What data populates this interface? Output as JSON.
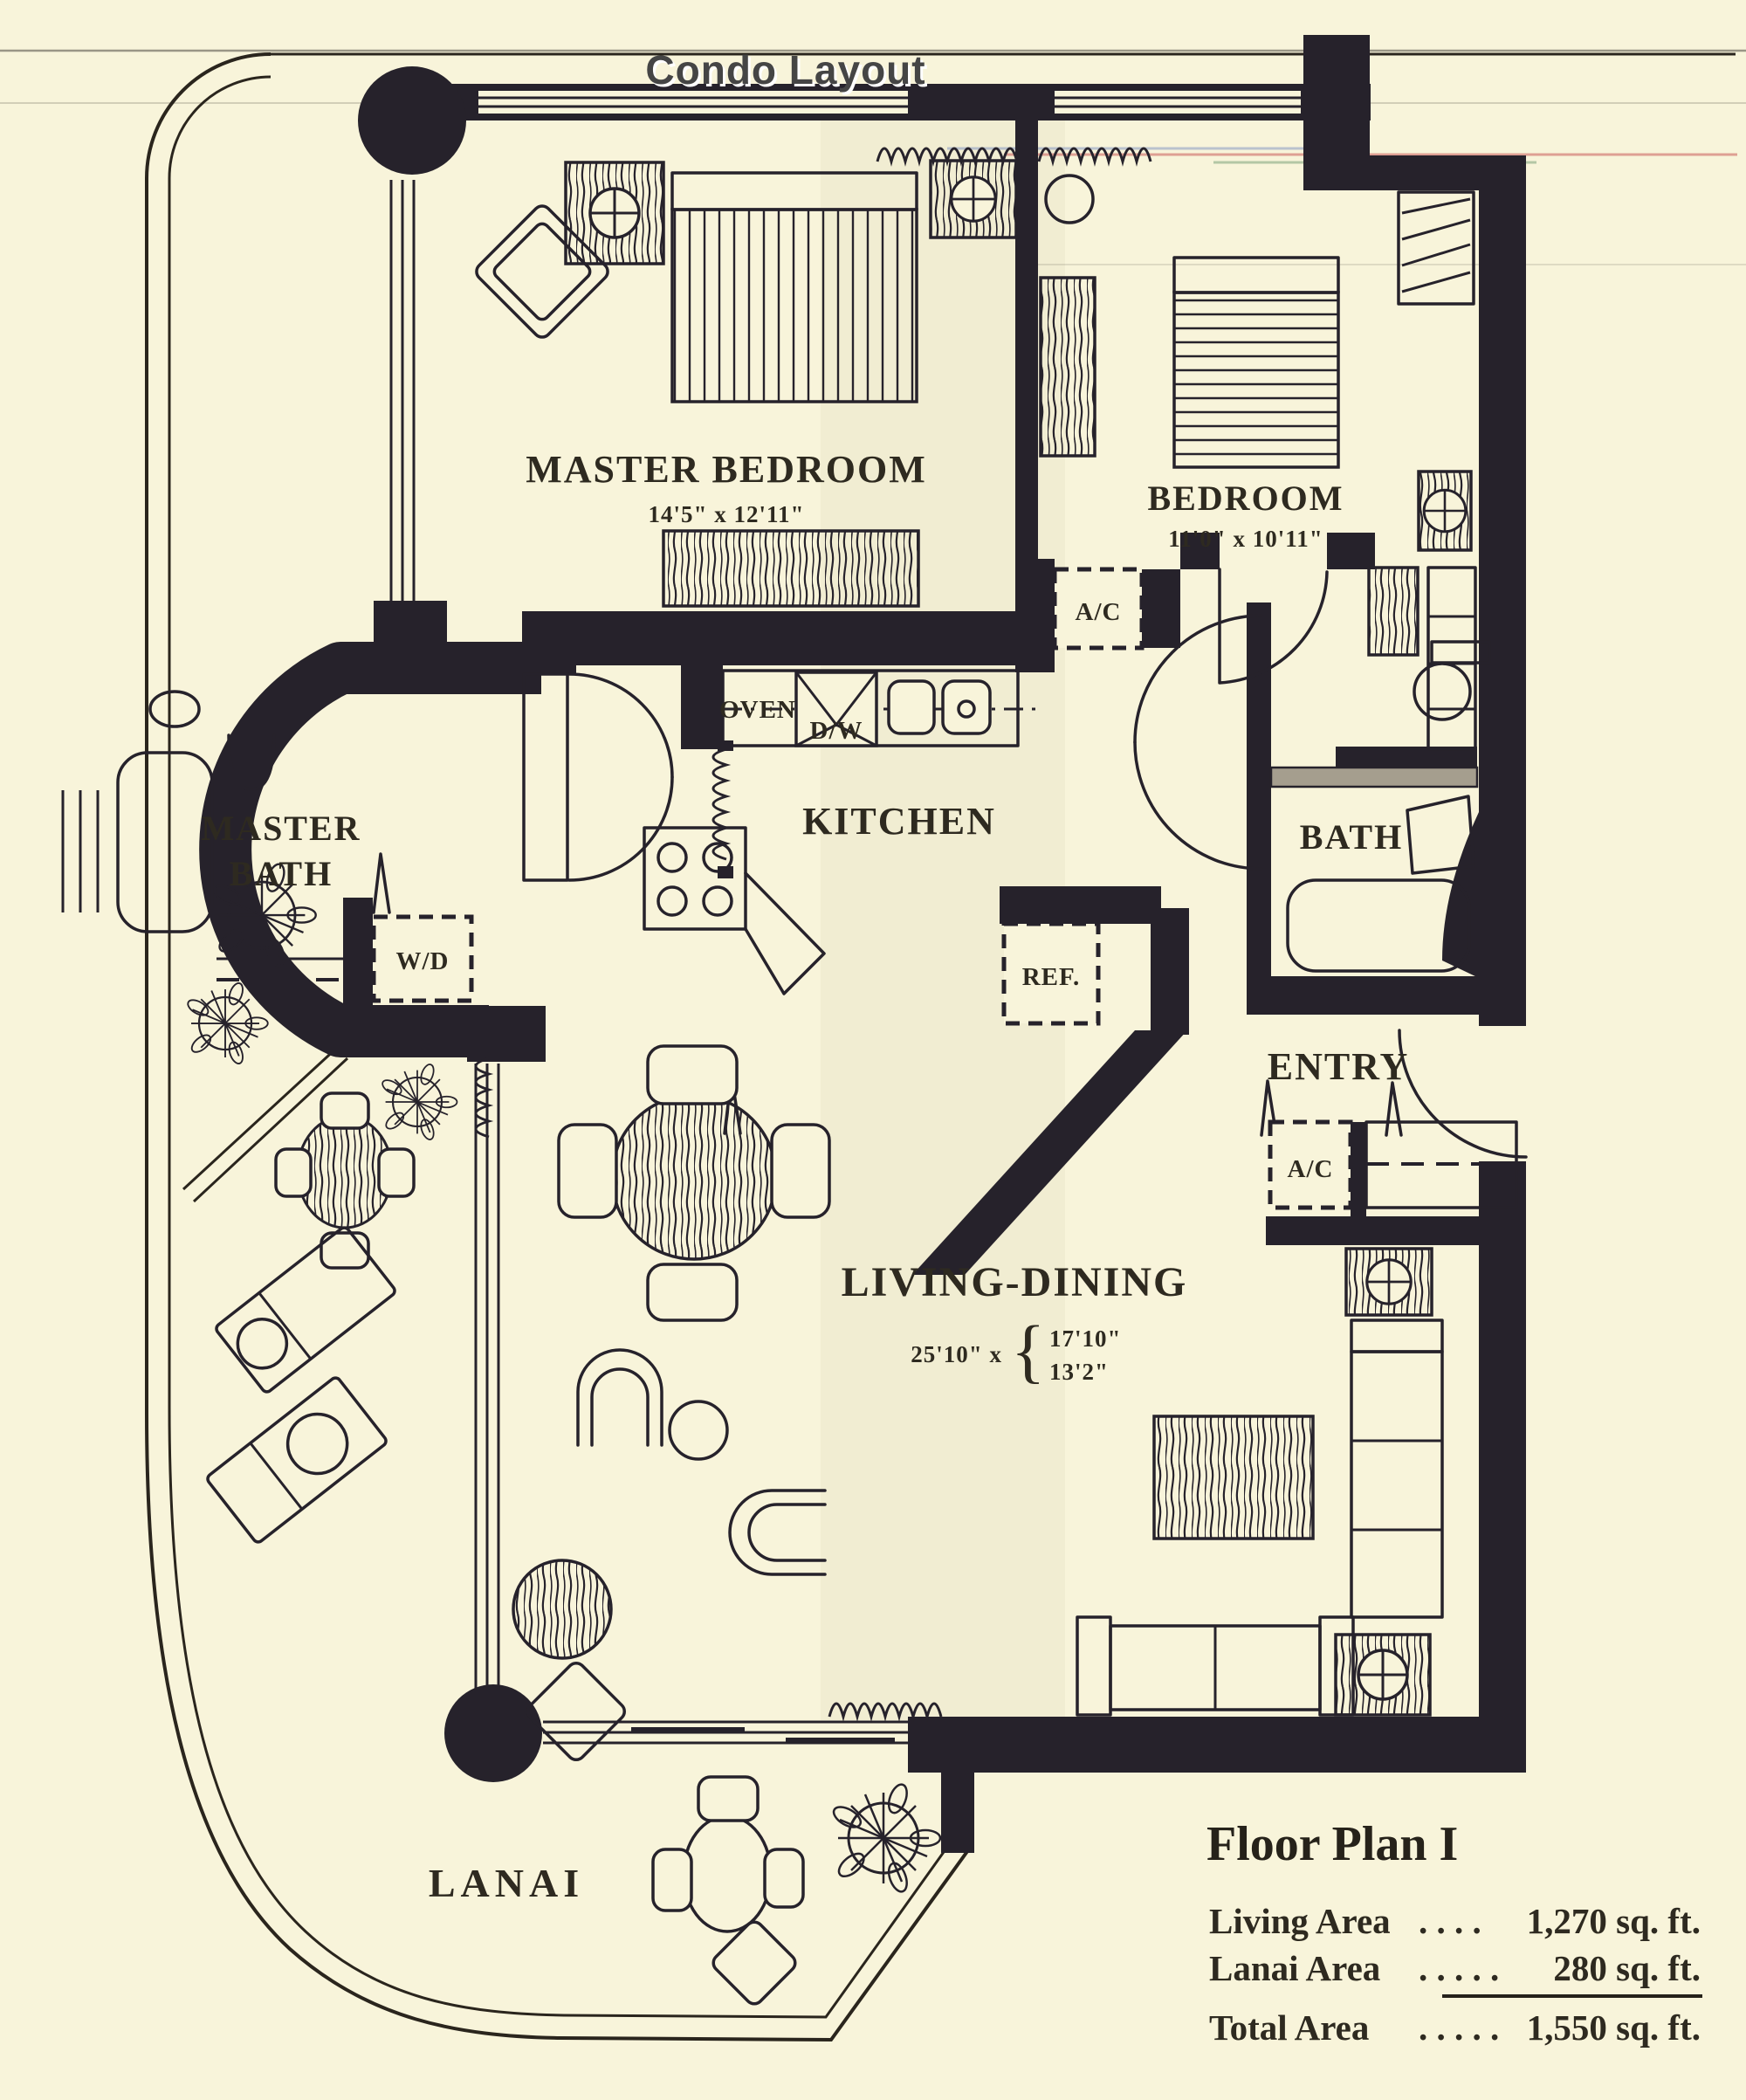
{
  "page": {
    "title": "Condo Layout"
  },
  "colors": {
    "paper": "#f8f4da",
    "ink": "#26222b",
    "title_shadow": "#ffffff",
    "vanity_gray": "#a59e8e",
    "artifact_red": "#c85a5a",
    "artifact_green": "#6f9a6f",
    "artifact_blue": "#7b8fc0"
  },
  "rooms": {
    "master_bedroom": {
      "name": "MASTER  BEDROOM",
      "dims": "14'5\" x 12'11\""
    },
    "bedroom": {
      "name": "BEDROOM",
      "dims": "11'0\" x 10'11\""
    },
    "kitchen": {
      "name": "KITCHEN"
    },
    "master_bath": {
      "line1": "MASTER",
      "line2": "BATH"
    },
    "bath": {
      "name": "BATH"
    },
    "entry": {
      "name": "ENTRY"
    },
    "living_dining": {
      "name": "LIVING-DINING",
      "dim_width": "25'10\" x",
      "brace": "{",
      "dim_a": "17'10\"",
      "dim_b": "13'2\""
    },
    "lanai": {
      "name": "LANAI"
    }
  },
  "appliances": {
    "oven": "OVEN",
    "dishwasher": "D/W",
    "refrigerator": "REF.",
    "ac_hall": "A/C",
    "ac_entry": "A/C",
    "washer_dryer": "W/D"
  },
  "legend": {
    "title": "Floor Plan I",
    "rows": [
      {
        "label": "Living Area",
        "dots": ". . . .",
        "value": "1,270 sq. ft."
      },
      {
        "label": "Lanai Area",
        "dots": ". . . . .",
        "value": "280 sq. ft."
      },
      {
        "label": "Total Area",
        "dots": ". . . . .",
        "value": "1,550 sq. ft."
      }
    ]
  }
}
